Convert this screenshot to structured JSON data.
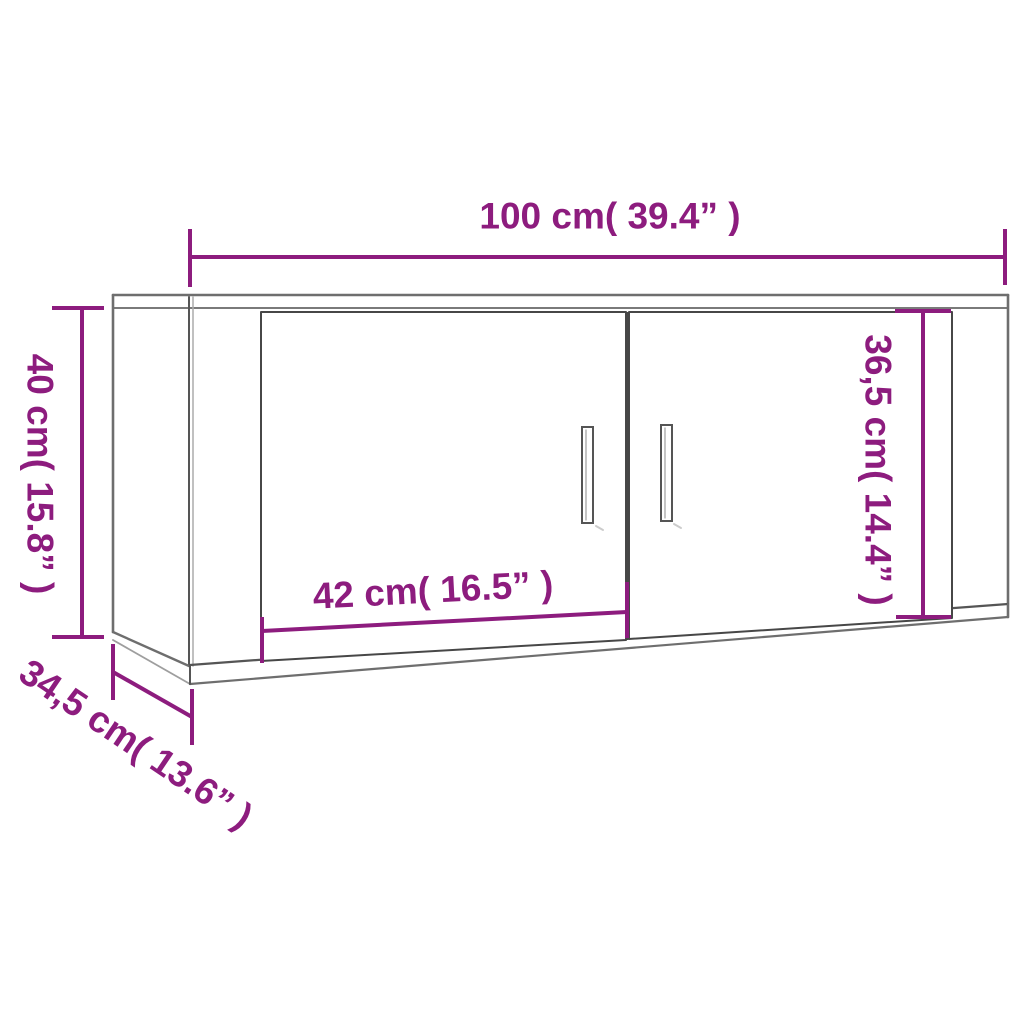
{
  "diagram": {
    "title": "Wall-mounted cabinet dimension diagram",
    "product": "wall cabinet with two doors and two bar handles",
    "colors": {
      "dimension_accent": "#8d1c7e",
      "outline_dark": "#474747",
      "outline_mid": "#6e6e6e",
      "outline_light": "#9e9e9e",
      "background": "#ffffff"
    },
    "dimensions": {
      "overall_width": {
        "label": "100 cm( 39.4” )",
        "cm": "100",
        "inches": "39.4"
      },
      "overall_height": {
        "label": "40 cm( 15.8” )",
        "cm": "40",
        "inches": "15.8"
      },
      "overall_depth": {
        "label": "34,5 cm( 13.6” )",
        "cm": "34,5",
        "inches": "13.6"
      },
      "door_width": {
        "label": "42 cm( 16.5” )",
        "cm": "42",
        "inches": "16.5"
      },
      "door_height": {
        "label": "36,5 cm( 14.4” )",
        "cm": "36,5",
        "inches": "14.4"
      }
    }
  }
}
